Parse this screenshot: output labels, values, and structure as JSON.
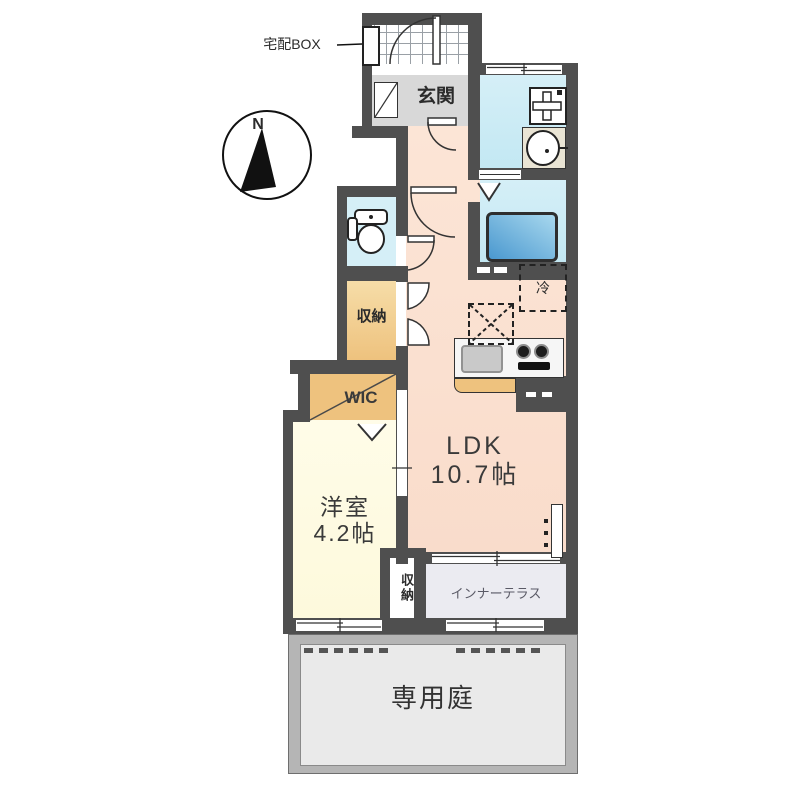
{
  "title": "apartment-floor-plan",
  "colors": {
    "wall": "#4f4f4f",
    "ldk": "#fce5d6",
    "ldk2": "#f9dccb",
    "yoshitsu": "#fdf9dc",
    "tan": "#eec27e",
    "tanlight": "#f6dda8",
    "blueroom": "#d5eff7",
    "blueroom2": "#c3e8f3",
    "genkan": "#d8d8d8",
    "terrace": "#ebebf1",
    "gardenframe": "#b5b5b5",
    "gardeninner": "#eaeaea",
    "tubdark": "#4a98cf",
    "tublight": "#a8d8ee",
    "counterface": "#e9e4d4"
  },
  "labels": {
    "compass_n": "N",
    "delivery_box": "宅配BOX",
    "entrance": "玄関",
    "storage_top": "収納",
    "wic": "WIC",
    "ldk_line1": "LDK",
    "ldk_line2": "10.7帖",
    "western_line1": "洋室",
    "western_line2": "4.2帖",
    "storage_bottom": "収納",
    "fridge": "冷",
    "inner_terrace": "インナーテラス",
    "private_garden": "専用庭"
  }
}
